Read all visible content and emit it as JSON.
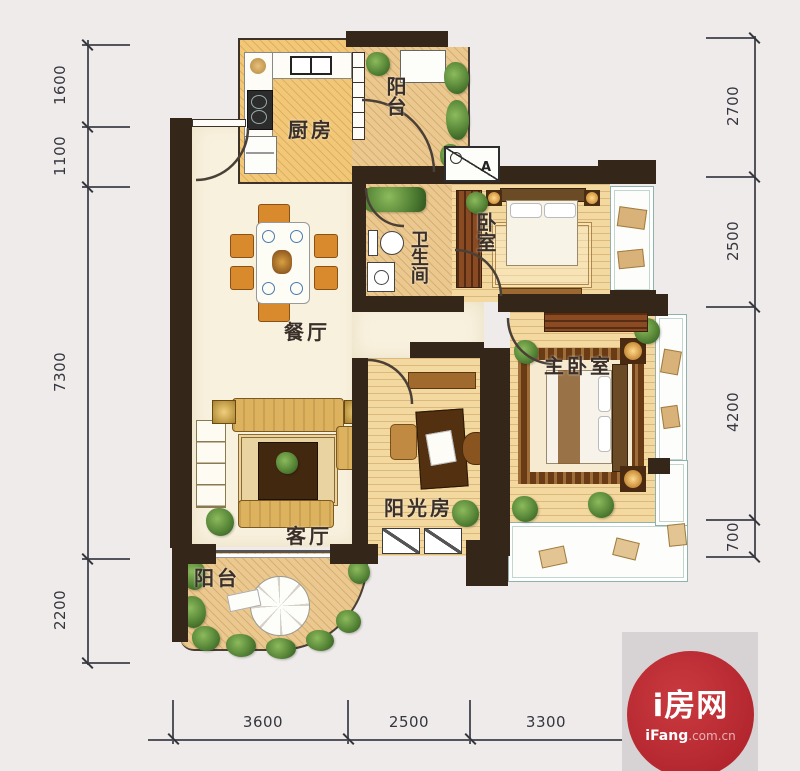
{
  "rooms": {
    "kitchen": "厨房",
    "balcony_top": "阳台",
    "bedroom": "卧室",
    "bathroom": "卫生间",
    "dining": "餐厅",
    "living": "客厅",
    "sunroom": "阳光房",
    "master": "主卧室",
    "balcony_bottom": "阳台"
  },
  "ac_unit": {
    "label": "A"
  },
  "dimensions": {
    "left": [
      "1600",
      "1100",
      "7300",
      "2200"
    ],
    "right": [
      "2700",
      "2500",
      "4200",
      "700"
    ],
    "bottom": [
      "3600",
      "2500",
      "3300"
    ]
  },
  "logo": {
    "title": "i房网",
    "domain_bold": "iFang",
    "domain_rest": ".com.cn"
  },
  "colors": {
    "wall": "#35261a",
    "floor_cream": "#f8f1de",
    "floor_warm": "#f3d89f",
    "plant_green": "#4d7c31",
    "bay_outline": "#8fb2aa",
    "dim_line": "#54555c",
    "logo_red": "#b2242c",
    "logo_bg": "#d7d2d3"
  }
}
